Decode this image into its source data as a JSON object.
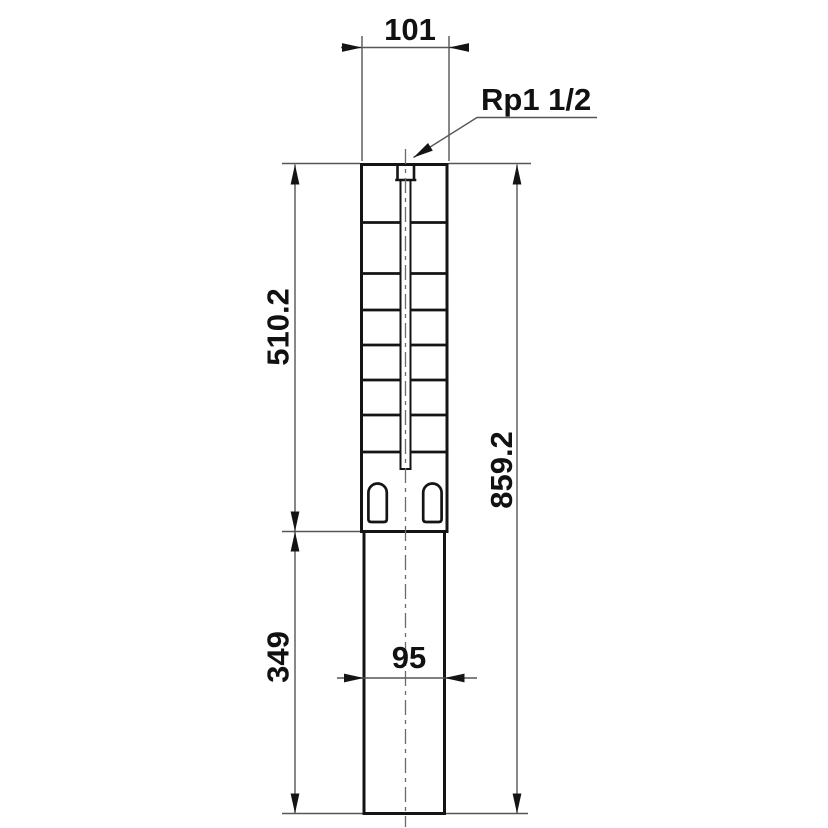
{
  "figure": {
    "kind": "technical-dimension-drawing",
    "colors": {
      "background": "#ffffff",
      "outline": "#141414",
      "dimension": "#565656",
      "centerline": "#6b6b6b",
      "text": "#111111"
    },
    "labels": {
      "width_top": "101",
      "thread_connection": "Rp1 1/2",
      "height_upper": "510.2",
      "height_lower": "349",
      "height_total": "859.2",
      "width_bottom": "95"
    }
  }
}
